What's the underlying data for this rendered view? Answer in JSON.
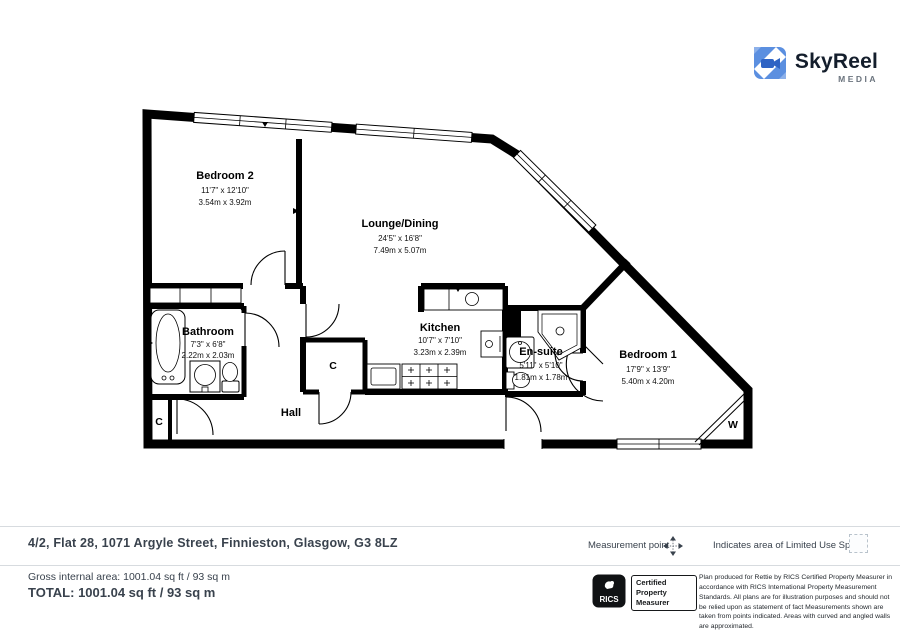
{
  "logo": {
    "name": "SkyReel",
    "tagline": "MEDIA",
    "accent": "#4a82d9"
  },
  "rooms": [
    {
      "name": "Bedroom 2",
      "imperial": "11'7\" x 12'10\"",
      "metric": "3.54m x 3.92m"
    },
    {
      "name": "Lounge/Dining",
      "imperial": "24'5\" x 16'8\"",
      "metric": "7.49m x 5.07m"
    },
    {
      "name": "Bathroom",
      "imperial": "7'3\" x 6'8\"",
      "metric": "2.22m x 2.03m"
    },
    {
      "name": "Kitchen",
      "imperial": "10'7\" x 7'10\"",
      "metric": "3.23m x 2.39m"
    },
    {
      "name": "En-suite",
      "imperial": "5'11\" x 5'10\"",
      "metric": "1.81m x 1.78m"
    },
    {
      "name": "Bedroom 1",
      "imperial": "17'9\" x 13'9\"",
      "metric": "5.40m x 4.20m"
    }
  ],
  "plan_labels": {
    "hall": "Hall",
    "closet": "C",
    "wardrobe": "W"
  },
  "footer": {
    "address": "4/2, Flat 28, 1071 Argyle Street, Finnieston, Glasgow, G3 8LZ",
    "legend_measurement": "Measurement point",
    "legend_limited_use": "Indicates area of  Limited Use Space",
    "gross_area": "Gross internal area: 1001.04 sq ft / 93 sq m",
    "total": "TOTAL: 1001.04 sq ft / 93 sq m",
    "rics_label": "RICS",
    "rics_cert_lines": [
      "Certified",
      "Property",
      "Measurer"
    ],
    "disclaimer": "Plan produced for Rettie by RICS Certified Property Measurer in accordance with RICS International Property Measurement Standards.  All plans are for illustration purposes and should not be relied upon as statement of fact Measurements shown are taken from points indicated. Areas with curved and angled walls are approximated."
  }
}
